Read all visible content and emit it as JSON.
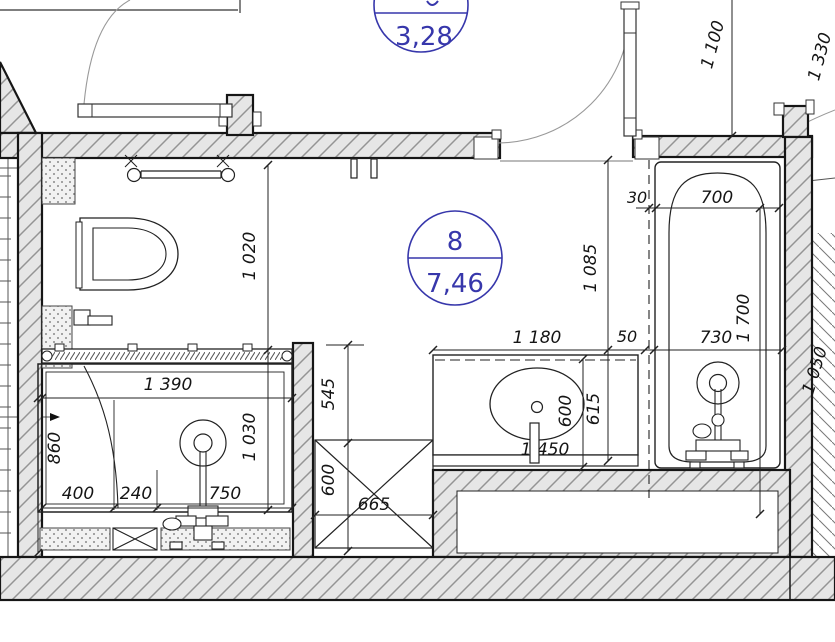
{
  "badges": {
    "top": {
      "area": "3,28"
    },
    "main": {
      "number": "8",
      "area": "7,46"
    }
  },
  "dims": {
    "v1100": "1 100",
    "v1330": "1 330",
    "v1020": "1 020",
    "v1085": "1 085",
    "n30": "30",
    "n700": "700",
    "v1700": "1 700",
    "n50_tub": "50",
    "n730": "730",
    "n1180": "1 180",
    "v600_sink": "600",
    "v615": "615",
    "n1450": "1 450",
    "n1390": "1 390",
    "v860": "860",
    "v1030": "1 030",
    "n400": "400",
    "n240": "240",
    "n750": "750",
    "v545": "545",
    "v600_box": "600",
    "n665": "665",
    "v1050": "1 050"
  },
  "colors": {
    "accent_blue": "#3737ab",
    "line": "#1a1a1a",
    "wall_fill": "#e6e6e6",
    "hatch_line": "#949494"
  }
}
